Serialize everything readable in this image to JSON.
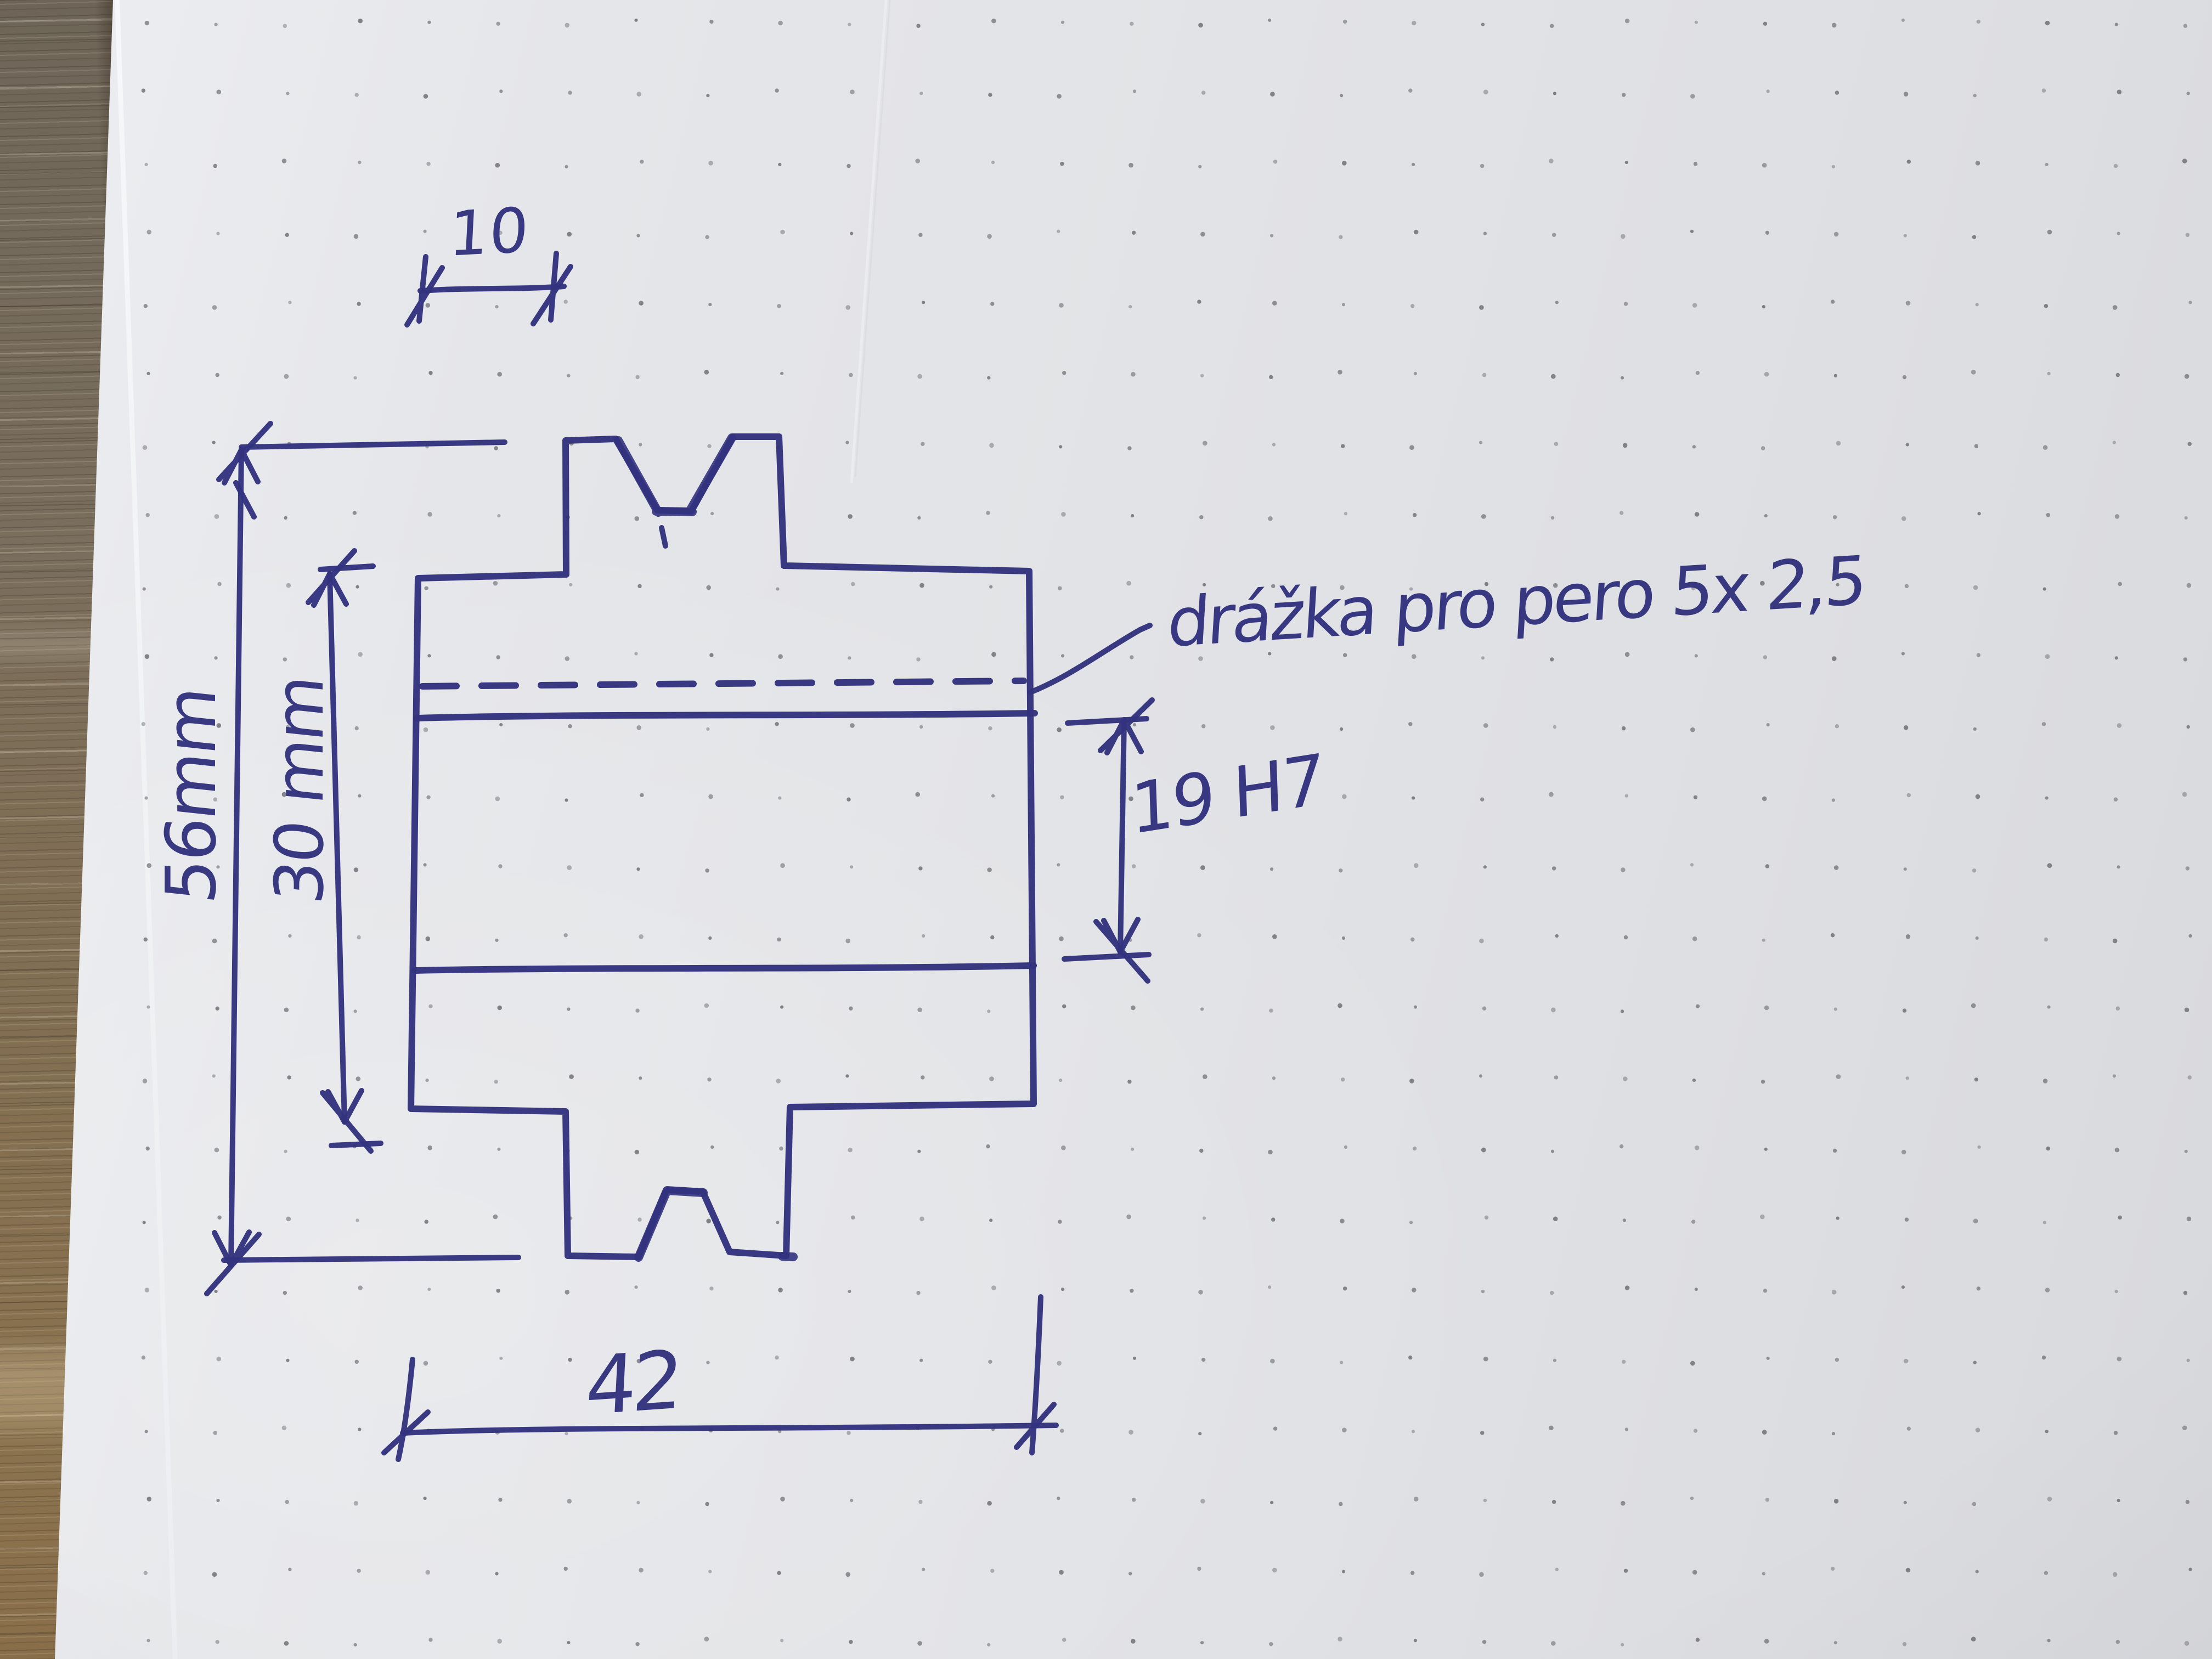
{
  "sketch": {
    "labels": {
      "hub_offset": "10",
      "outer_diameter": "56mm",
      "hub_diameter": "30 mm",
      "overall_length": "42",
      "bore": "19 H7",
      "keyway_note": "drážka pro pero 5x 2,5"
    },
    "colors": {
      "ink": "#32327e",
      "dot": "#6d6d74",
      "paper": "#e2e3e6",
      "wood": "#82705a"
    }
  }
}
